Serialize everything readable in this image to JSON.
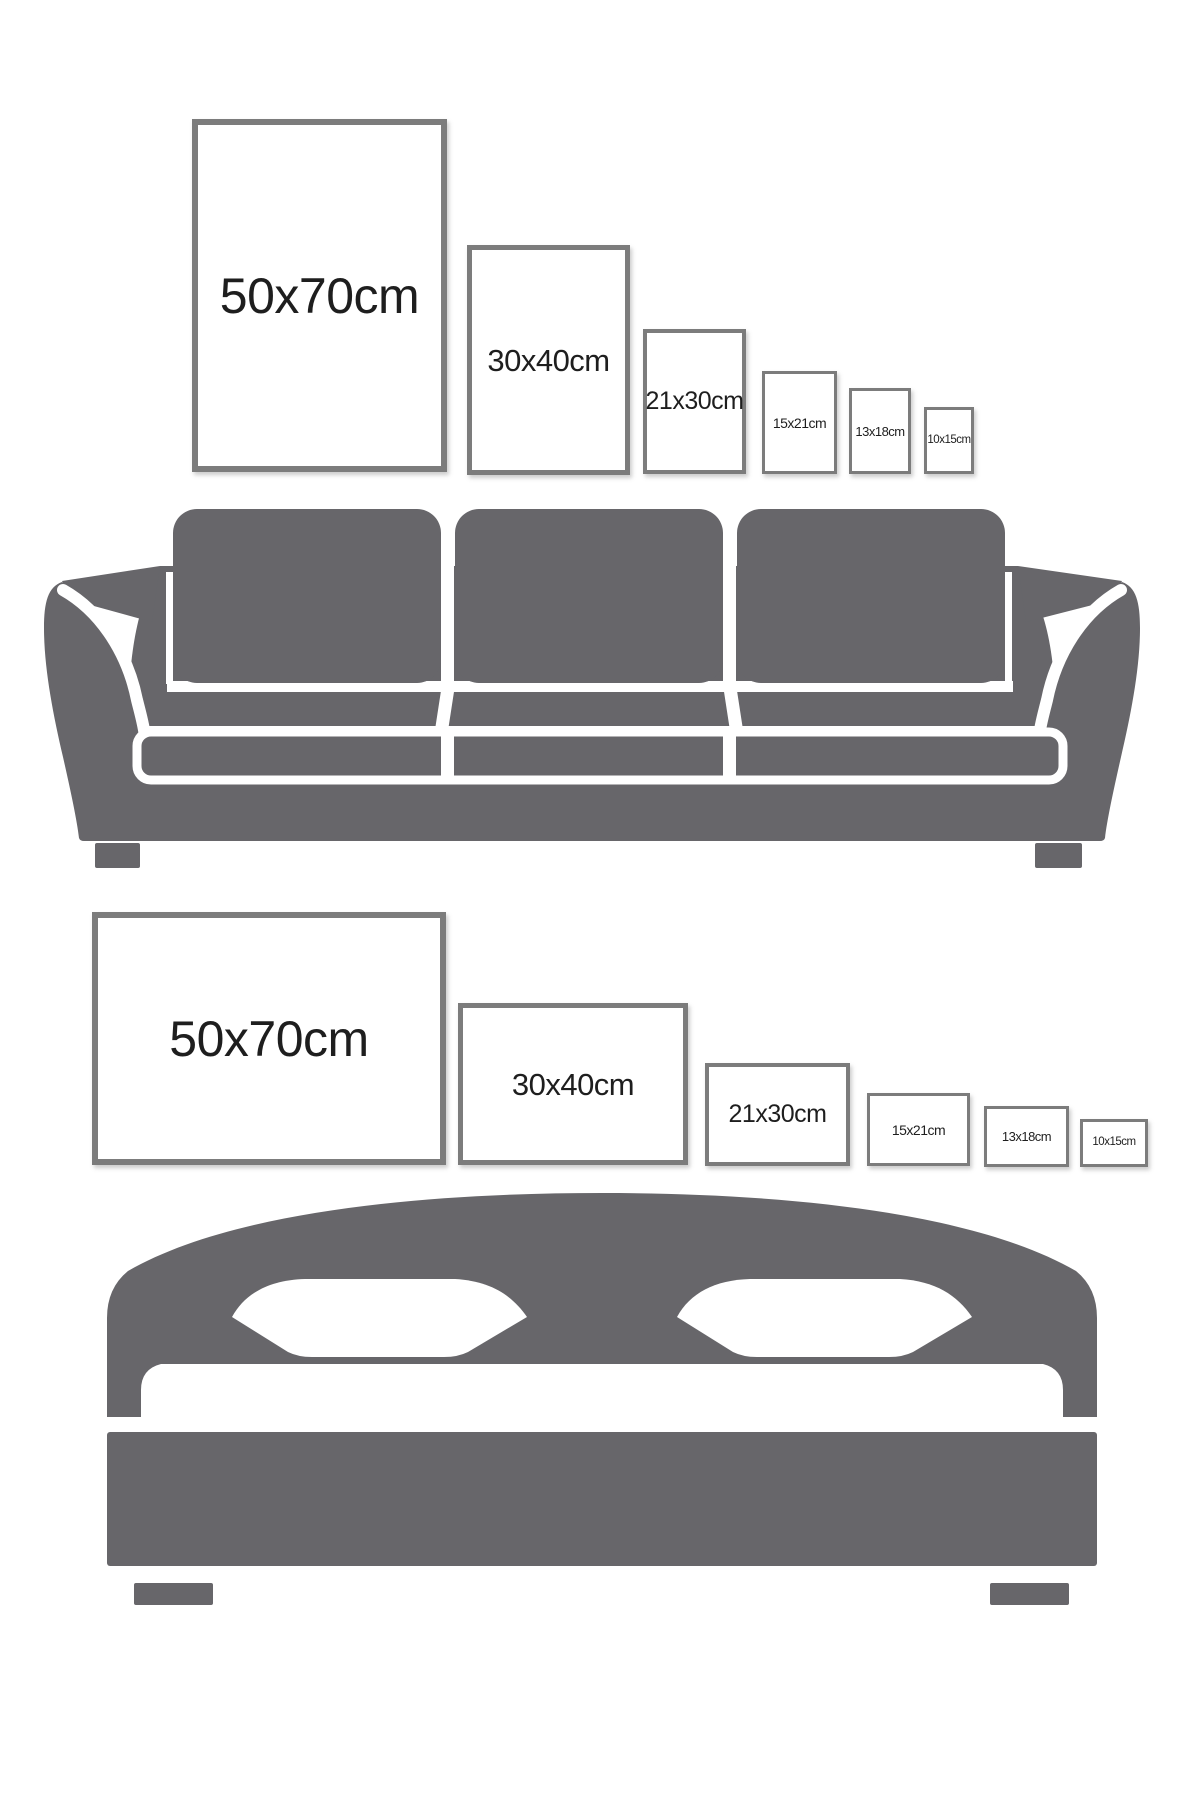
{
  "colors": {
    "furniture": "#67666a",
    "frame_border": "#7c7c7c",
    "label_text": "#1e1e1e"
  },
  "rows": [
    {
      "name": "portrait-sizes-above-sofa",
      "orientation": "portrait",
      "illustration": "sofa",
      "frames": [
        {
          "label": "50x70cm"
        },
        {
          "label": "30x40cm"
        },
        {
          "label": "21x30cm"
        },
        {
          "label": "15x21cm"
        },
        {
          "label": "13x18cm"
        },
        {
          "label": "10x15cm"
        }
      ]
    },
    {
      "name": "landscape-sizes-above-bed",
      "orientation": "landscape",
      "illustration": "bed",
      "frames": [
        {
          "label": "50x70cm"
        },
        {
          "label": "30x40cm"
        },
        {
          "label": "21x30cm"
        },
        {
          "label": "15x21cm"
        },
        {
          "label": "13x18cm"
        },
        {
          "label": "10x15cm"
        }
      ]
    }
  ]
}
